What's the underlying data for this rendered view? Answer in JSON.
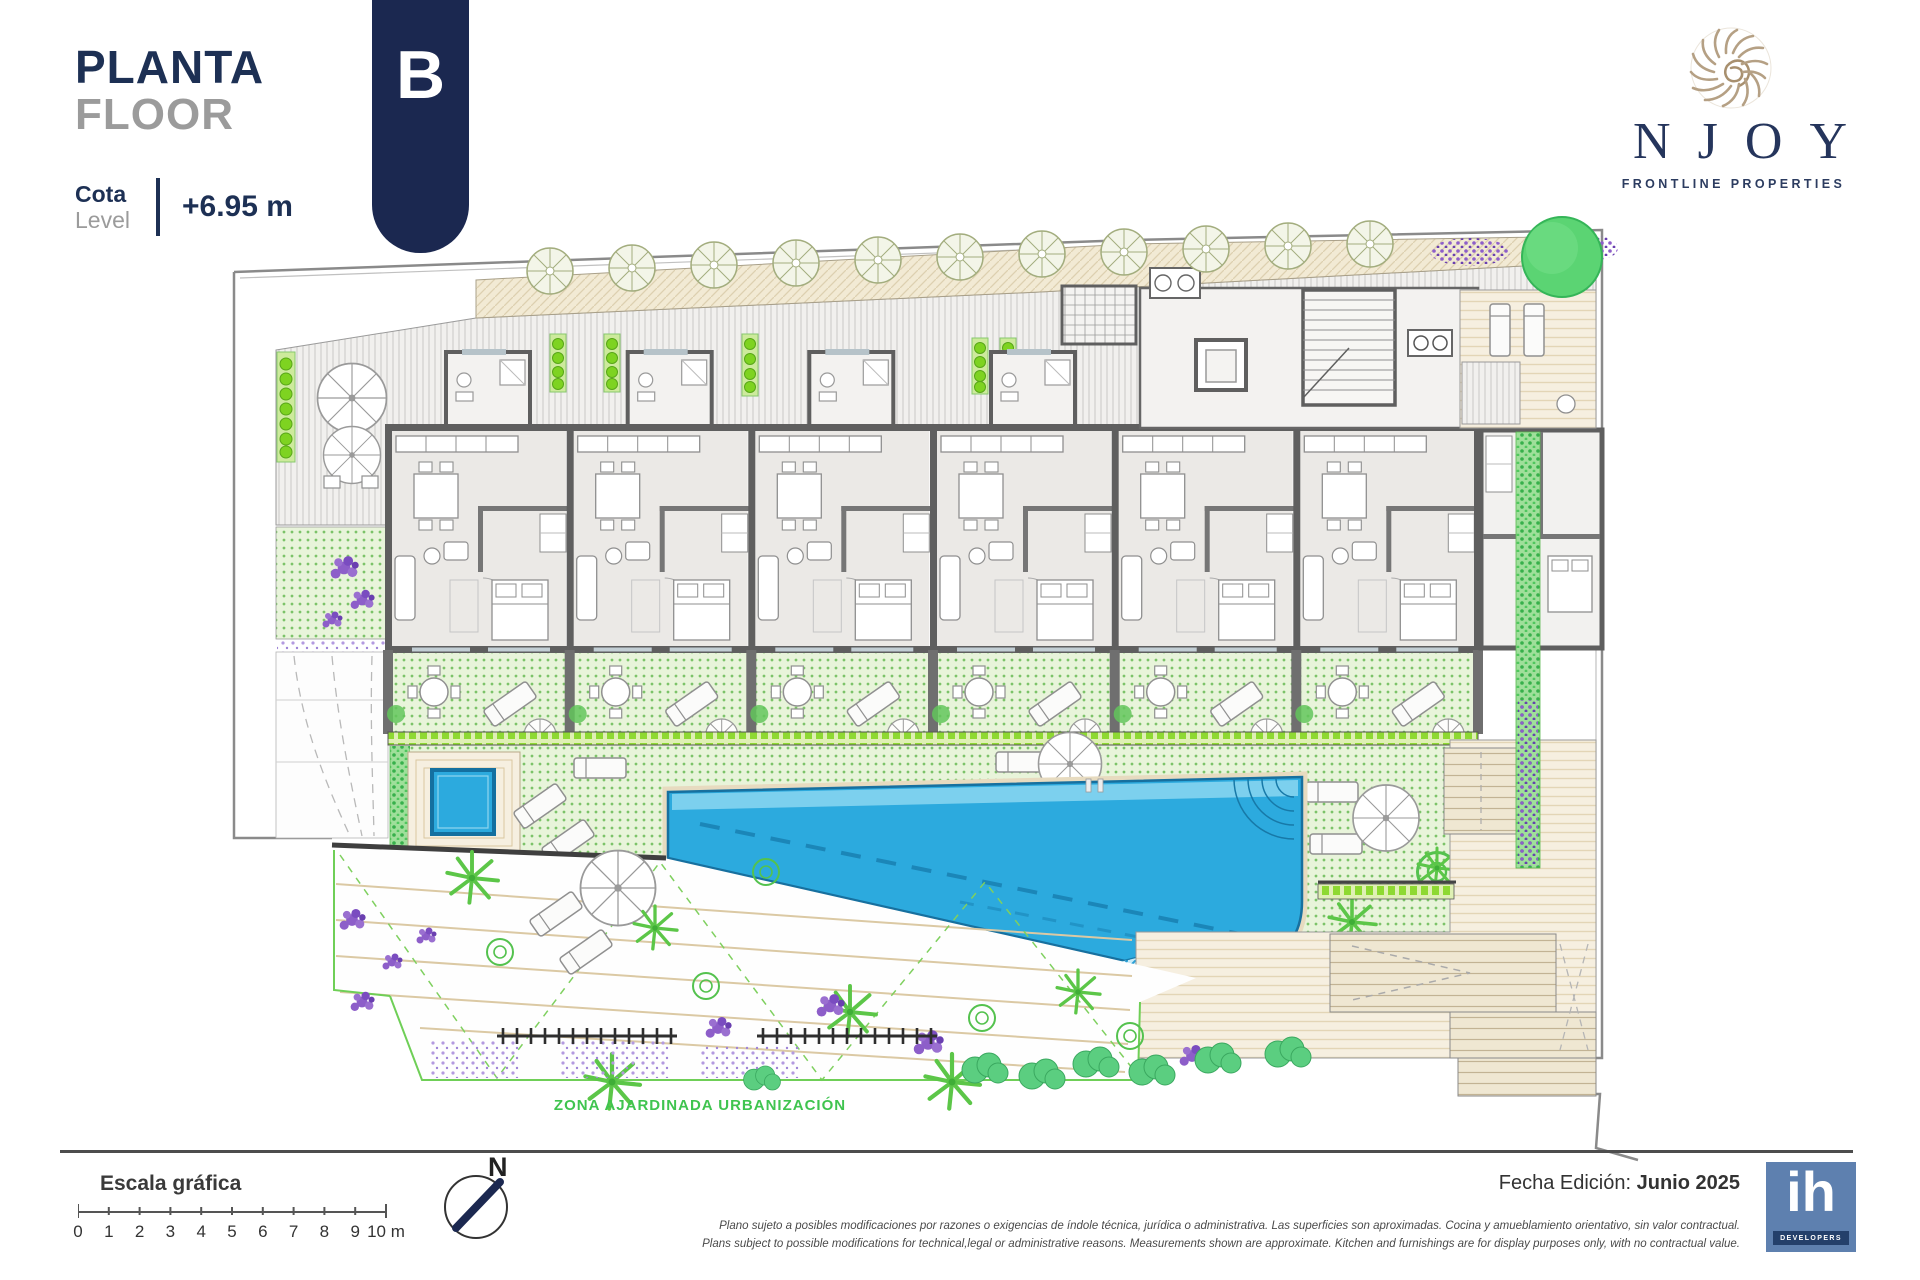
{
  "header": {
    "title_primary": "PLANTA",
    "title_secondary": "FLOOR",
    "cota_label": "Cota",
    "level_label": "Level",
    "level_value": "+6.95 m",
    "block_letter": "B"
  },
  "brand": {
    "name": "NJOY",
    "tagline": "FRONTLINE PROPERTIES",
    "logo_icon": "nautilus-shell-icon"
  },
  "plan": {
    "garden_zone_label": "ZONA AJARDINADA URBANIZACIÓN",
    "features": [
      "apartment-units",
      "terraces",
      "main-pool",
      "plunge-pool",
      "lawn",
      "garden",
      "stair-core",
      "elevator",
      "sun-deck",
      "ramp",
      "hedges",
      "trees"
    ]
  },
  "footer": {
    "scale_title": "Escala gráfica",
    "scale_labels": [
      "0",
      "1",
      "2",
      "3",
      "4",
      "5",
      "6",
      "7",
      "8",
      "9",
      "10"
    ],
    "scale_unit": "m",
    "north_label": "N",
    "edition_label": "Fecha Edición:",
    "edition_value": "Junio 2025",
    "disclaimer_es": "Plano sujeto a posibles modificaciones por razones o exigencias de índole técnica,  jurídica o administrativa. Las superficies son aproximadas. Cocina y amueblamiento orientativo, sin valor contractual.",
    "disclaimer_en": "Plans subject to possible modifications for technical,legal or administrative reasons. Measurements shown are approximate. Kitchen and furnishings are for display purposes only, with no contractual value.",
    "developer": {
      "abbr": "ih",
      "name": "DEVELOPERS"
    }
  },
  "colors": {
    "navy": "#1b2850",
    "title_navy": "#1d3054",
    "gray_text": "#9b9b9b",
    "brand_gold": "#b3a186",
    "pool_blue": "#2caade",
    "lawn_green": "#e8f4da",
    "planter_green": "#8ed932",
    "flower_purple": "#8d5ec9",
    "developer_blue": "#5e80af"
  }
}
